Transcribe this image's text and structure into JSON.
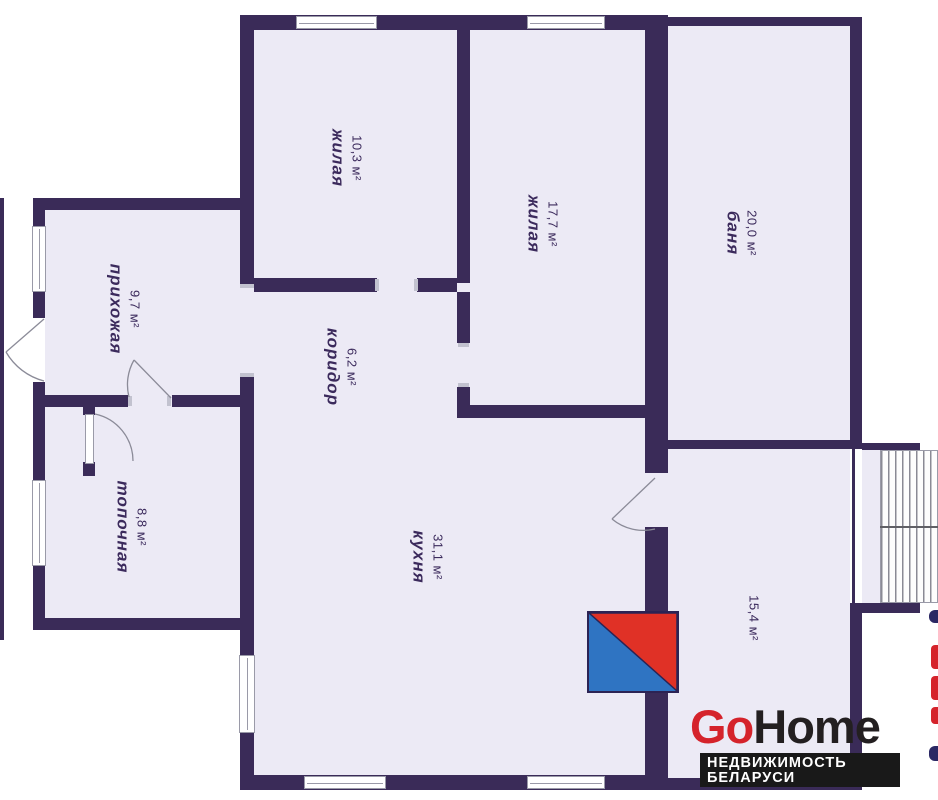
{
  "plan": {
    "rooms": [
      {
        "id": "zhilaya-1",
        "name": "жилая",
        "area": "10,3 м²"
      },
      {
        "id": "zhilaya-2",
        "name": "жилая",
        "area": "17,7 м²"
      },
      {
        "id": "banya",
        "name": "баня",
        "area": "20,0 м²"
      },
      {
        "id": "prihozhaya",
        "name": "прихожая",
        "area": "9,7 м²"
      },
      {
        "id": "koridor",
        "name": "коридор",
        "area": "6,2 м²"
      },
      {
        "id": "topochnaya",
        "name": "топочная",
        "area": "8,8 м²"
      },
      {
        "id": "kuhnya",
        "name": "кухня",
        "area": "31,1 м²"
      },
      {
        "id": "room-154",
        "name": "",
        "area": "15,4 м²"
      }
    ],
    "colors": {
      "wall": "#3a2b58",
      "room_fill": "#eceaf5",
      "stove_red": "#e03126",
      "stove_blue": "#2f74c2"
    }
  },
  "logo": {
    "part1": "Go",
    "part2": "Home",
    "tagline": "НЕДВИЖИМОСТЬ БЕЛАРУСИ",
    "color_go": "#d5232b",
    "color_home": "#231f20"
  }
}
